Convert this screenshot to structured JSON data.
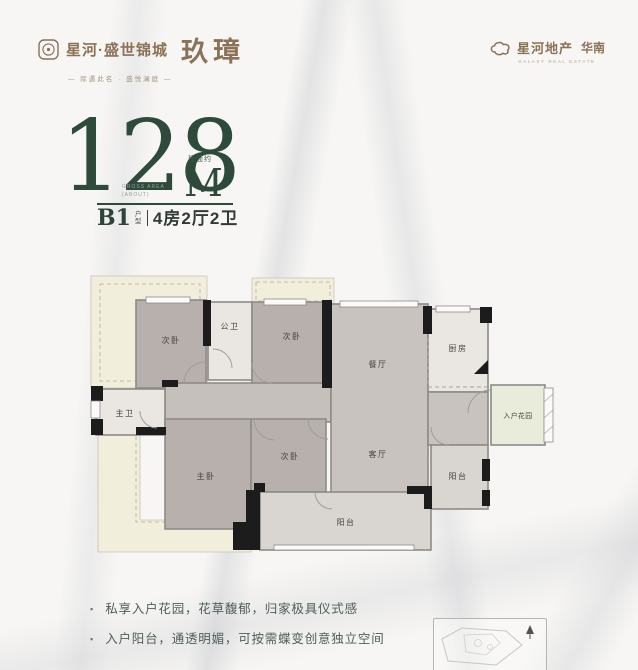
{
  "brand": {
    "project_name": "星河·盛世锦城",
    "product_name": "玖璋",
    "tagline": "— 际遇此名 · 盛悦澜庭 —",
    "developer": "星河地产",
    "region": "华南",
    "developer_en": "GALAXY REAL ESTATE"
  },
  "headline": {
    "area_prefix": "建面约",
    "area_value": "128",
    "area_unit": "M",
    "area_exp": "2",
    "note_line1": "Gross area",
    "note_line2": "(about)",
    "unit_code": "B1",
    "unit_type_label": "户型",
    "unit_spec": "4房2厅2卫"
  },
  "floorplan": {
    "rooms": [
      {
        "id": "bedroom-top-left",
        "label": "次卧"
      },
      {
        "id": "bath-public",
        "label": "公卫"
      },
      {
        "id": "bedroom-top-mid",
        "label": "次卧"
      },
      {
        "id": "dining-room",
        "label": "餐厅"
      },
      {
        "id": "kitchen",
        "label": "厨房"
      },
      {
        "id": "entry-garden",
        "label": "入户花园"
      },
      {
        "id": "bath-master",
        "label": "主卫"
      },
      {
        "id": "bedroom-master",
        "label": "主卧"
      },
      {
        "id": "bedroom-mid",
        "label": "次卧"
      },
      {
        "id": "living-room",
        "label": "客厅"
      },
      {
        "id": "balcony-entry",
        "label": "阳台"
      },
      {
        "id": "balcony-south",
        "label": "阳台"
      }
    ]
  },
  "features": [
    "私享入户花园，花草馥郁，归家极具仪式感",
    "入户阳台，通透明媚，可按需蝶变创意独立空间"
  ],
  "features_bullet": "▪",
  "icons": {
    "seal": "seal-icon",
    "cloud_logo": "cloud-logo-icon",
    "north_arrow": "north-arrow-icon"
  },
  "colors": {
    "accent_green": "#2d4a3b",
    "brand_brown": "#8a7256",
    "room_fill": "#b7b0ac",
    "hall_fill": "#c9c3bf",
    "wet_fill": "#eae7e2",
    "balcony_fill": "#d9d5d0",
    "garden_fill": "#e9ecda",
    "bay_fill": "#f2eedc",
    "wall_black": "#1c1c1c",
    "wall_gray": "#8e8b87"
  }
}
